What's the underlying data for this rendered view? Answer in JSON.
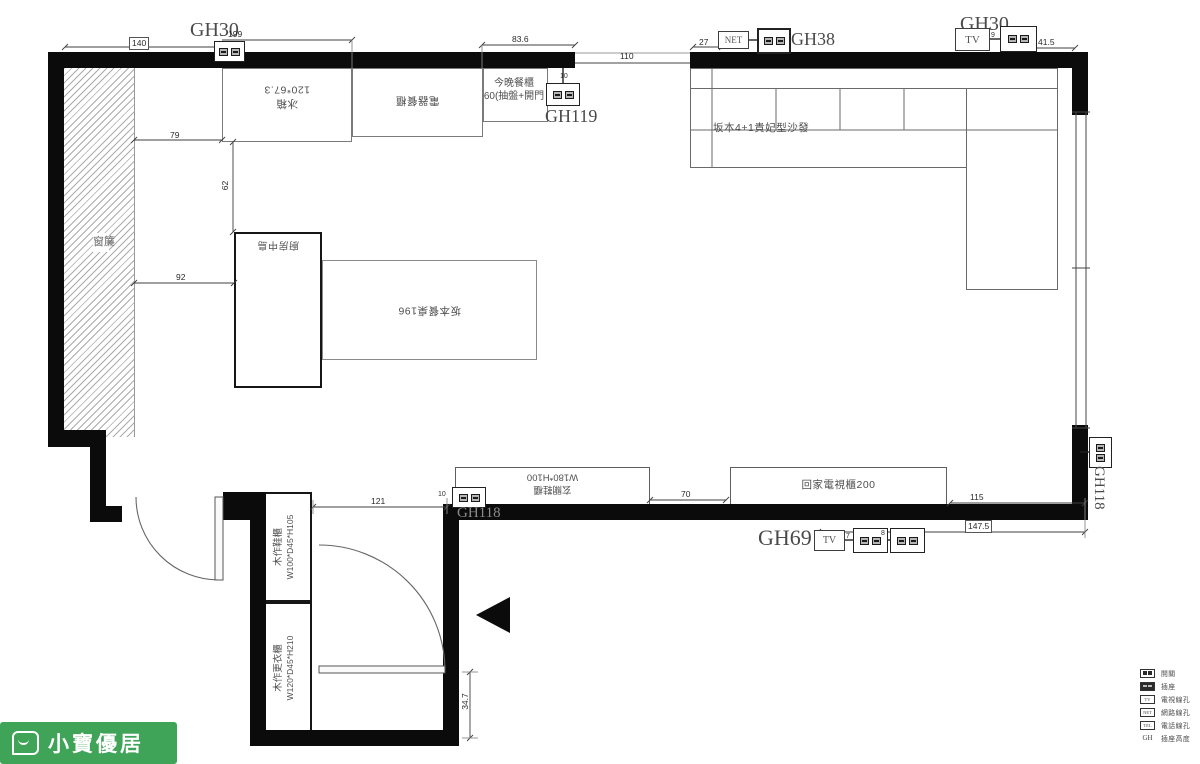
{
  "logo": {
    "text": "小寶優居"
  },
  "areas": {
    "curtain": "窗簾"
  },
  "kitchen": {
    "fridge_l1": "冰箱",
    "fridge_l2": "120*67.3",
    "appliance_cabinet": "電器餐櫃",
    "dinner_cabinet_l1": "今晚餐櫃",
    "dinner_cabinet_l2": "60(抽盤+開門",
    "island": "廚房中島",
    "table": "坂本餐桌196"
  },
  "living": {
    "sofa": "坂本4+1貴妃型沙發",
    "tv_cabinet": "回家電視櫃200",
    "entry_cabinet_l1": "玄關鞋櫃",
    "entry_cabinet_l2": "W180*H100"
  },
  "entry": {
    "shoe_cabinet_l1": "木作鞋櫃",
    "shoe_cabinet_l2": "W100*D45*H105",
    "wardrobe_l1": "木作更衣櫃",
    "wardrobe_l2": "W120*D45*H210"
  },
  "gh": {
    "gh30_left": "GH30",
    "gh119": "GH119",
    "gh38": "GH38",
    "gh30_right": "GH30",
    "gh69": "GH69",
    "gh118_wall": "GH118",
    "gh118_right": "GH118",
    "net": "NET",
    "tv_top": "TV",
    "tv_bottom": "TV"
  },
  "dims": {
    "d140": "140",
    "d199": "199",
    "d79": "79",
    "d836": "83.6",
    "d110": "110",
    "d27": "27",
    "d415": "41.5",
    "d62": "62",
    "d92": "92",
    "d121": "121",
    "d70": "70",
    "d115": "115",
    "d1475": "147.5",
    "d347": "34.7",
    "n10a": "10",
    "n10b": "10",
    "n9": "9",
    "n7": "7",
    "n8": "8"
  },
  "legend": {
    "rows": [
      {
        "icon": "outlet",
        "icon_text": "",
        "label": "開關"
      },
      {
        "icon": "outlet-dark",
        "icon_text": "",
        "label": "插座"
      },
      {
        "icon": "tv",
        "icon_text": "TV",
        "label": "電視線孔"
      },
      {
        "icon": "net",
        "icon_text": "NET",
        "label": "網路線孔"
      },
      {
        "icon": "tel",
        "icon_text": "TEL",
        "label": "電話線孔"
      },
      {
        "icon": "gh",
        "icon_text": "GH",
        "label": "插座高度"
      }
    ]
  },
  "colors": {
    "wall": "#0b0b0b",
    "logo_green": "#3FA457",
    "line": "#555555"
  }
}
